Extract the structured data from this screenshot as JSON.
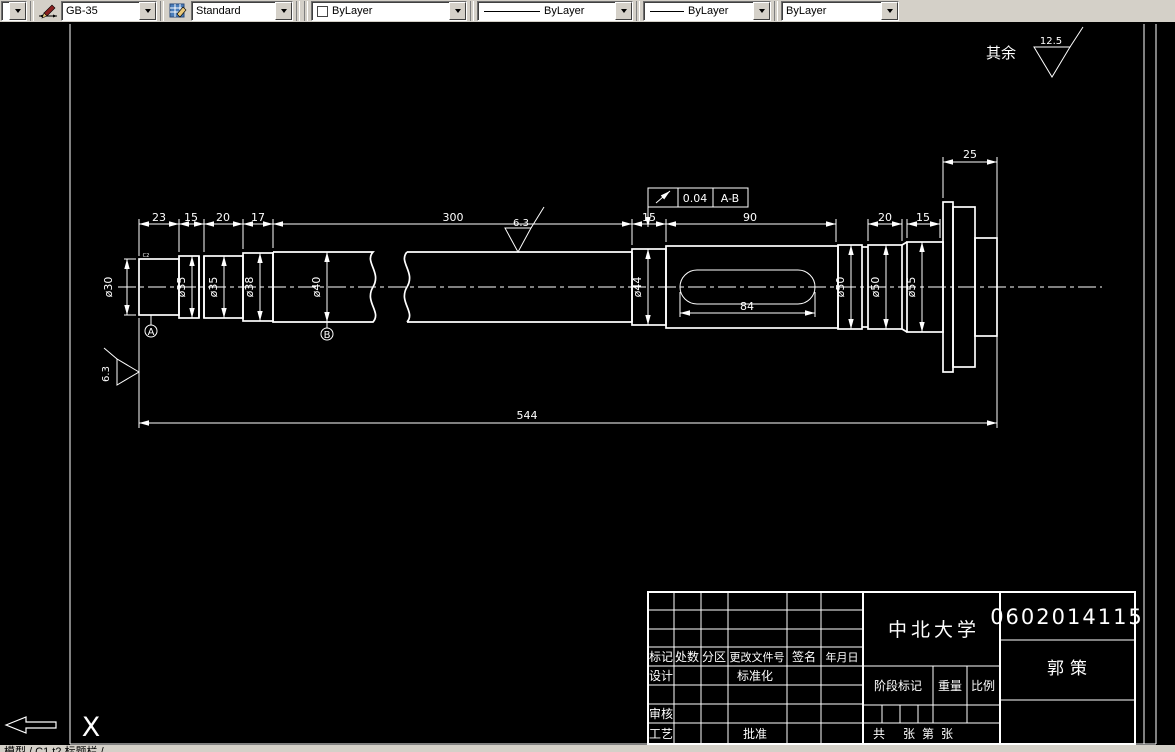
{
  "toolbar": {
    "dim_style": "GB-35",
    "text_style": "Standard",
    "color": "ByLayer",
    "linetype": "ByLayer",
    "lineweight": "ByLayer",
    "plot_style": "ByLayer"
  },
  "drawing": {
    "general_roughness_label": "其余",
    "general_roughness_value": "12.5",
    "body_roughness_value": "6.3",
    "end_roughness_value": "6.3",
    "tolerance_value": "0.04",
    "tolerance_datum": "A-B",
    "datum_a": "A",
    "datum_b": "B",
    "note": "C2",
    "ucs_x": "X",
    "dims": {
      "seg1": "23",
      "seg2": "15",
      "seg3": "20",
      "seg4": "17",
      "body": "300",
      "relief": "15",
      "key_section": "90",
      "d50b_len": "20",
      "d55_len": "15",
      "flange": "25",
      "keyway": "84",
      "total": "544"
    },
    "diameters": {
      "d30": "ø30",
      "d35a": "ø35",
      "d35b": "ø35",
      "d38": "ø38",
      "d40": "ø40",
      "d44": "ø44",
      "d50a": "ø50",
      "d50b": "ø50",
      "d55": "ø55"
    }
  },
  "title_block": {
    "university": "中北大学",
    "drawing_no": "0602014115",
    "author": "郭策",
    "labels": {
      "mark": "标记",
      "count": "处数",
      "zone": "分区",
      "change_doc": "更改文件号",
      "signature": "签名",
      "date": "年月日",
      "design": "设计",
      "standardize": "标准化",
      "check": "审核",
      "process": "工艺",
      "approve": "批准",
      "stage_mark": "阶段标记",
      "weight": "重量",
      "scale": "比例",
      "total_lbl": "共",
      "sheet1": "张",
      "no_lbl": "第",
      "sheet2": "张"
    }
  },
  "tab_bar": {
    "text": "模型 / C1 t2 标题栏 /"
  }
}
